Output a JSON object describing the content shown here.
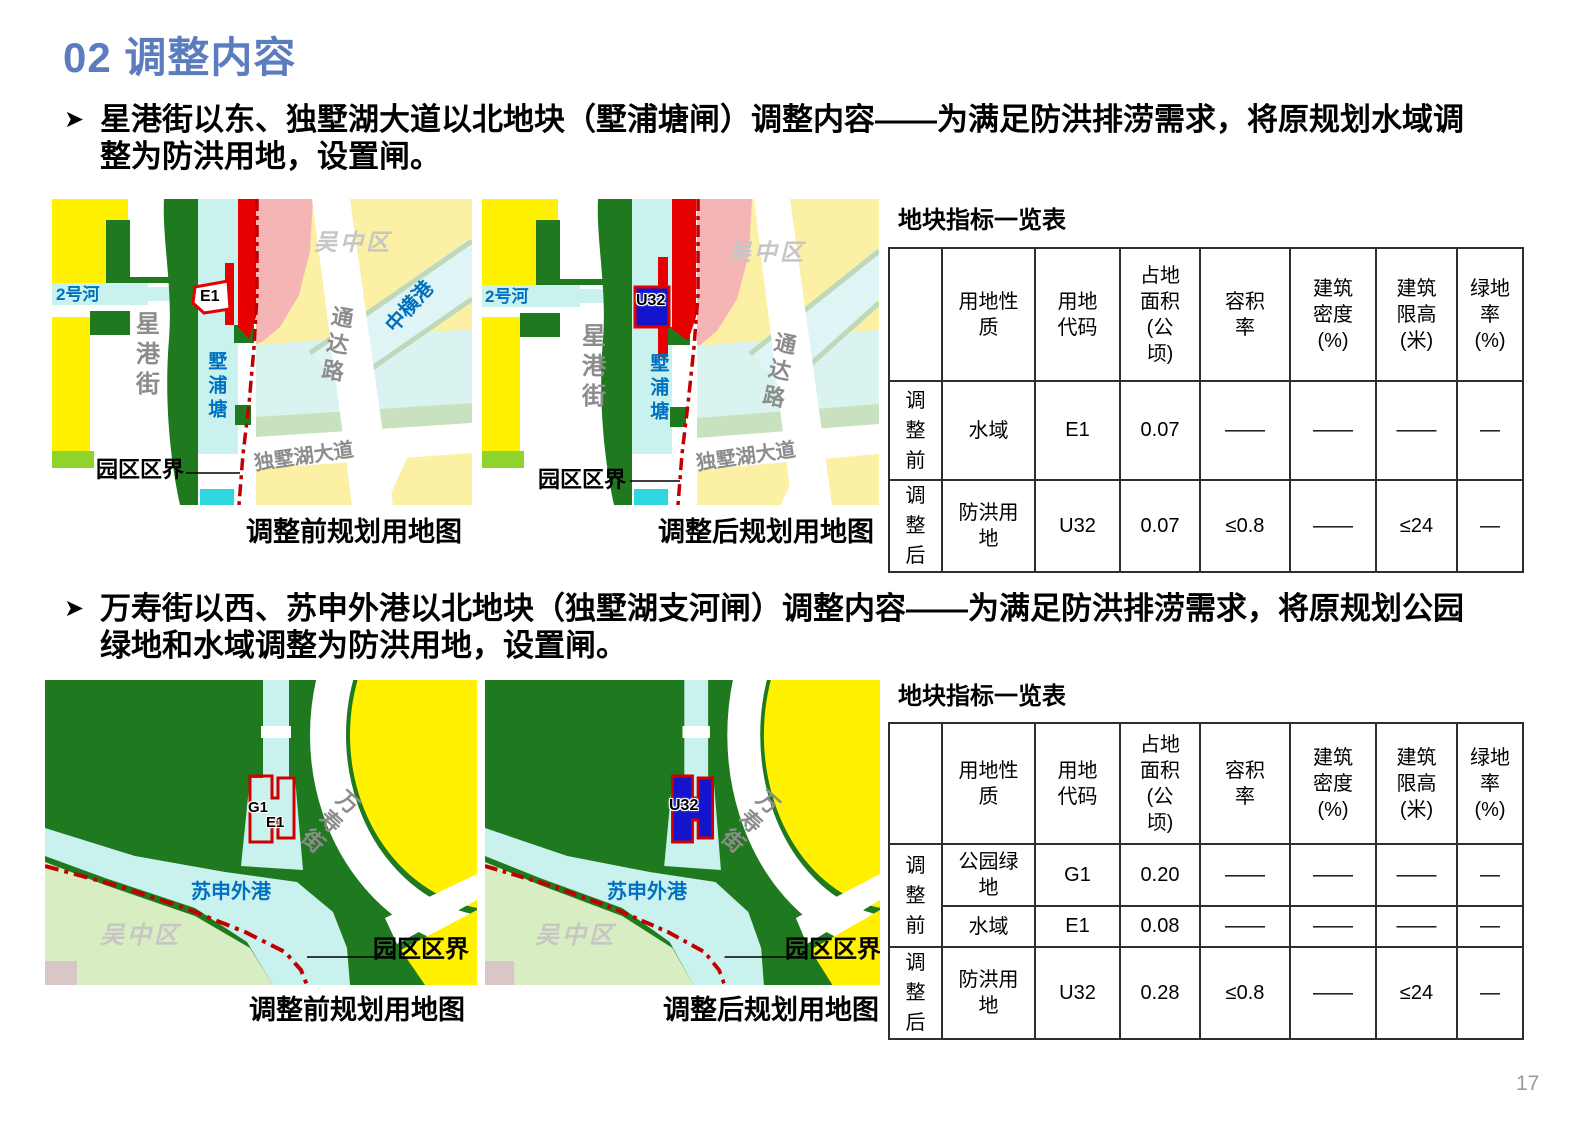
{
  "slide": {
    "title": "02 调整内容",
    "page_number": "17"
  },
  "colors": {
    "title_blue": "#5C7CC0",
    "dark_green": "#1F7A1F",
    "bright_yellow": "#FFF100",
    "pale_yellow": "#FBF0A4",
    "light_cyan": "#C9F2EE",
    "pale_cyan": "#DCF4F2",
    "salmon_pink": "#F6B5B5",
    "red_parcel": "#E60000",
    "boundary_red": "#C00000",
    "parcel_blue": "#1414CC",
    "label_blue": "#0070C0",
    "road_gray": "#8C8C8C",
    "district_gray": "#C6C6C6",
    "pale_green": "#D9EDC3",
    "pink_gray": "#D9C6C6"
  },
  "sections": [
    {
      "bullet": "星港街以东、独墅湖大道以北地块（墅浦塘闸）调整内容——为满足防洪排涝需求，将原规划水域调整为防洪用地，设置闸。",
      "map_before": {
        "caption": "调整前规划用地图",
        "labels": {
          "river_small": "2号河",
          "street": "星港街",
          "parcel": "E1",
          "river_main": "墅浦塘",
          "district": "吴中区",
          "canal": "中横港",
          "road": "通达路",
          "avenue": "独墅湖大道",
          "boundary": "园区区界"
        }
      },
      "map_after": {
        "caption": "调整后规划用地图",
        "labels": {
          "river_small": "2号河",
          "street": "星港街",
          "parcel": "U32",
          "river_main": "墅浦塘",
          "district": "吴中区",
          "road": "通达路",
          "avenue": "独墅湖大道",
          "boundary": "园区区界"
        }
      },
      "table": {
        "title": "地块指标一览表",
        "headers": [
          "",
          "用地性质",
          "用地代码",
          "占地面积(公顷)",
          "容积率",
          "建筑密度(%)",
          "建筑限高(米)",
          "绿地率(%)"
        ],
        "rows": [
          {
            "stage": "调整前",
            "use": "水域",
            "code": "E1",
            "area": "0.07",
            "far": "——",
            "density": "——",
            "height": "——",
            "green": "—"
          },
          {
            "stage": "调整后",
            "use": "防洪用地",
            "code": "U32",
            "area": "0.07",
            "far": "≤0.8",
            "density": "——",
            "height": "≤24",
            "green": "—"
          }
        ]
      }
    },
    {
      "bullet": "万寿街以西、苏申外港以北地块（独墅湖支河闸）调整内容——为满足防洪排涝需求，将原规划公园绿地和水域调整为防洪用地，设置闸。",
      "map_before": {
        "caption": "调整前规划用地图",
        "labels": {
          "river": "苏申外港",
          "street": "万寿街",
          "parcel_g": "G1",
          "parcel_e": "E1",
          "district": "吴中区",
          "boundary": "园区区界"
        }
      },
      "map_after": {
        "caption": "调整后规划用地图",
        "labels": {
          "river": "苏申外港",
          "street": "万寿街",
          "parcel": "U32",
          "district": "吴中区",
          "boundary": "园区区界"
        }
      },
      "table": {
        "title": "地块指标一览表",
        "headers": [
          "",
          "用地性质",
          "用地代码",
          "占地面积(公顷)",
          "容积率",
          "建筑密度(%)",
          "建筑限高(米)",
          "绿地率(%)"
        ],
        "rows": [
          {
            "stage": "调整前",
            "use": "公园绿地",
            "code": "G1",
            "area": "0.20",
            "far": "——",
            "density": "——",
            "height": "——",
            "green": "—"
          },
          {
            "use": "水域",
            "code": "E1",
            "area": "0.08",
            "far": "——",
            "density": "——",
            "height": "——",
            "green": "—"
          },
          {
            "stage": "调整后",
            "use": "防洪用地",
            "code": "U32",
            "area": "0.28",
            "far": "≤0.8",
            "density": "——",
            "height": "≤24",
            "green": "—"
          }
        ]
      }
    }
  ]
}
